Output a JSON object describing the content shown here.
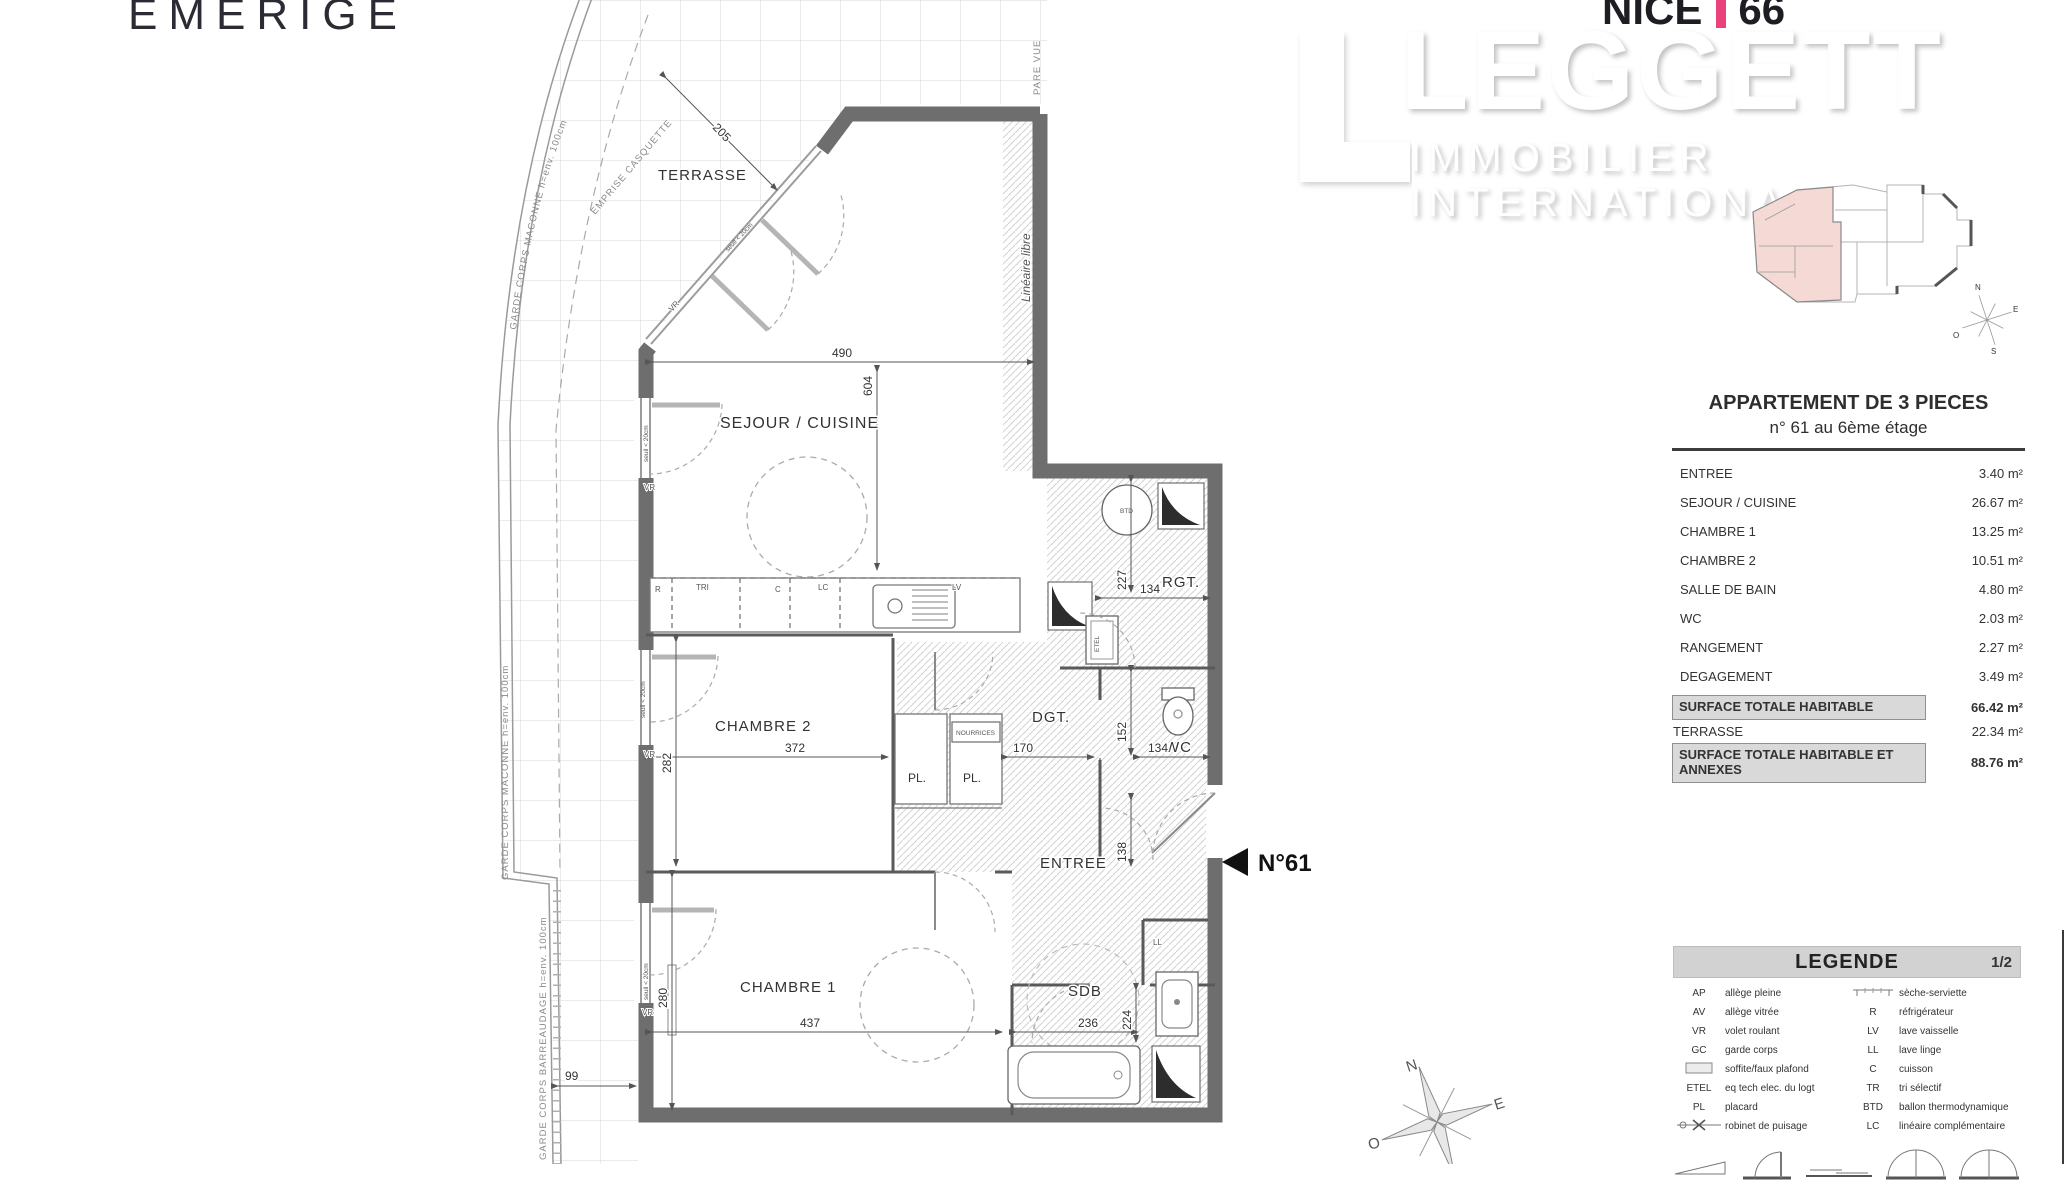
{
  "branding": {
    "developer_logo": "EMERIGE",
    "program_name": "NICE",
    "program_number": "66",
    "agency_name": "LEGGETT",
    "agency_subtitle": "IMMOBILIER INTERNATIONAL",
    "accent_pink": "#e8417c"
  },
  "title_block": {
    "title": "APPARTEMENT DE 3 PIECES",
    "subtitle": "n° 61 au 6ème étage",
    "rows": [
      {
        "label": "ENTREE",
        "value": "3.40 m²"
      },
      {
        "label": "SEJOUR / CUISINE",
        "value": "26.67 m²"
      },
      {
        "label": "CHAMBRE 1",
        "value": "13.25 m²"
      },
      {
        "label": "CHAMBRE 2",
        "value": "10.51 m²"
      },
      {
        "label": "SALLE DE BAIN",
        "value": "4.80 m²"
      },
      {
        "label": "WC",
        "value": "2.03 m²"
      },
      {
        "label": "RANGEMENT",
        "value": "2.27 m²"
      },
      {
        "label": "DEGAGEMENT",
        "value": "3.49 m²"
      }
    ],
    "totals": [
      {
        "label": "SURFACE TOTALE HABITABLE",
        "value": "66.42 m²"
      },
      {
        "label": "TERRASSE",
        "value": "22.34 m²"
      },
      {
        "label": "SURFACE TOTALE HABITABLE ET ANNEXES",
        "value": "88.76 m²"
      }
    ]
  },
  "legend": {
    "title": "LEGENDE",
    "page": "1/2",
    "left": [
      {
        "abbr": "AP",
        "label": "allège pleine"
      },
      {
        "abbr": "AV",
        "label": "allège vitrée"
      },
      {
        "abbr": "VR",
        "label": "volet roulant"
      },
      {
        "abbr": "GC",
        "label": "garde corps"
      },
      {
        "abbr": "",
        "label": "soffite/faux plafond"
      },
      {
        "abbr": "ETEL",
        "label": "eq tech elec. du logt"
      },
      {
        "abbr": "PL",
        "label": "placard"
      },
      {
        "abbr": "",
        "label": "robinet de puisage"
      }
    ],
    "right": [
      {
        "abbr": "",
        "label": "sèche-serviette"
      },
      {
        "abbr": "R",
        "label": "réfrigérateur"
      },
      {
        "abbr": "LV",
        "label": "lave vaisselle"
      },
      {
        "abbr": "LL",
        "label": "lave linge"
      },
      {
        "abbr": "C",
        "label": "cuisson"
      },
      {
        "abbr": "TR",
        "label": "tri sélectif"
      },
      {
        "abbr": "BTD",
        "label": "ballon thermodynamique"
      },
      {
        "abbr": "LC",
        "label": "linéaire complémentaire"
      }
    ]
  },
  "plan": {
    "unit_marker": "N°61",
    "rooms": {
      "terrasse": "TERRASSE",
      "sejour": "SEJOUR / CUISINE",
      "chambre2": "CHAMBRE 2",
      "chambre1": "CHAMBRE 1",
      "dgt": "DGT.",
      "rgt": "RGT.",
      "wc": "WC",
      "entree": "ENTREE",
      "sdb": "SDB",
      "pl1": "PL.",
      "pl2": "PL."
    },
    "dims": {
      "d490": "490",
      "d604": "604",
      "d205": "205",
      "d227": "227",
      "d134_rgt": "134",
      "d152": "152",
      "d134_wc": "134",
      "d138": "138",
      "d282": "282",
      "d372": "372",
      "d170": "170",
      "d280": "280",
      "d437": "437",
      "d99": "99",
      "d236": "236",
      "d224": "224"
    },
    "equip": {
      "btd": "BTD",
      "etel": "ETEL",
      "ll": "LL",
      "vr": "VR",
      "r": "R",
      "tri": "TRI",
      "c": "C",
      "lc": "LC",
      "lv": "LV",
      "nourrices": "NOURRICES"
    },
    "annotations": {
      "garde_corps_maconne": "GARDE CORPS MACONNE  h=env. 100cm",
      "garde_corps_barreaudage": "GARDE CORPS BARREAUDAGE  h=env. 100cm",
      "emprise_casquette": "EMPRISE CASQUETTE",
      "pare_vue": "PARE VUE",
      "lineaire_libre": "Linéaire libre",
      "seuil": "seuil < 20cm"
    }
  },
  "compass": {
    "n": "N",
    "e": "E",
    "s": "S",
    "o": "O"
  }
}
